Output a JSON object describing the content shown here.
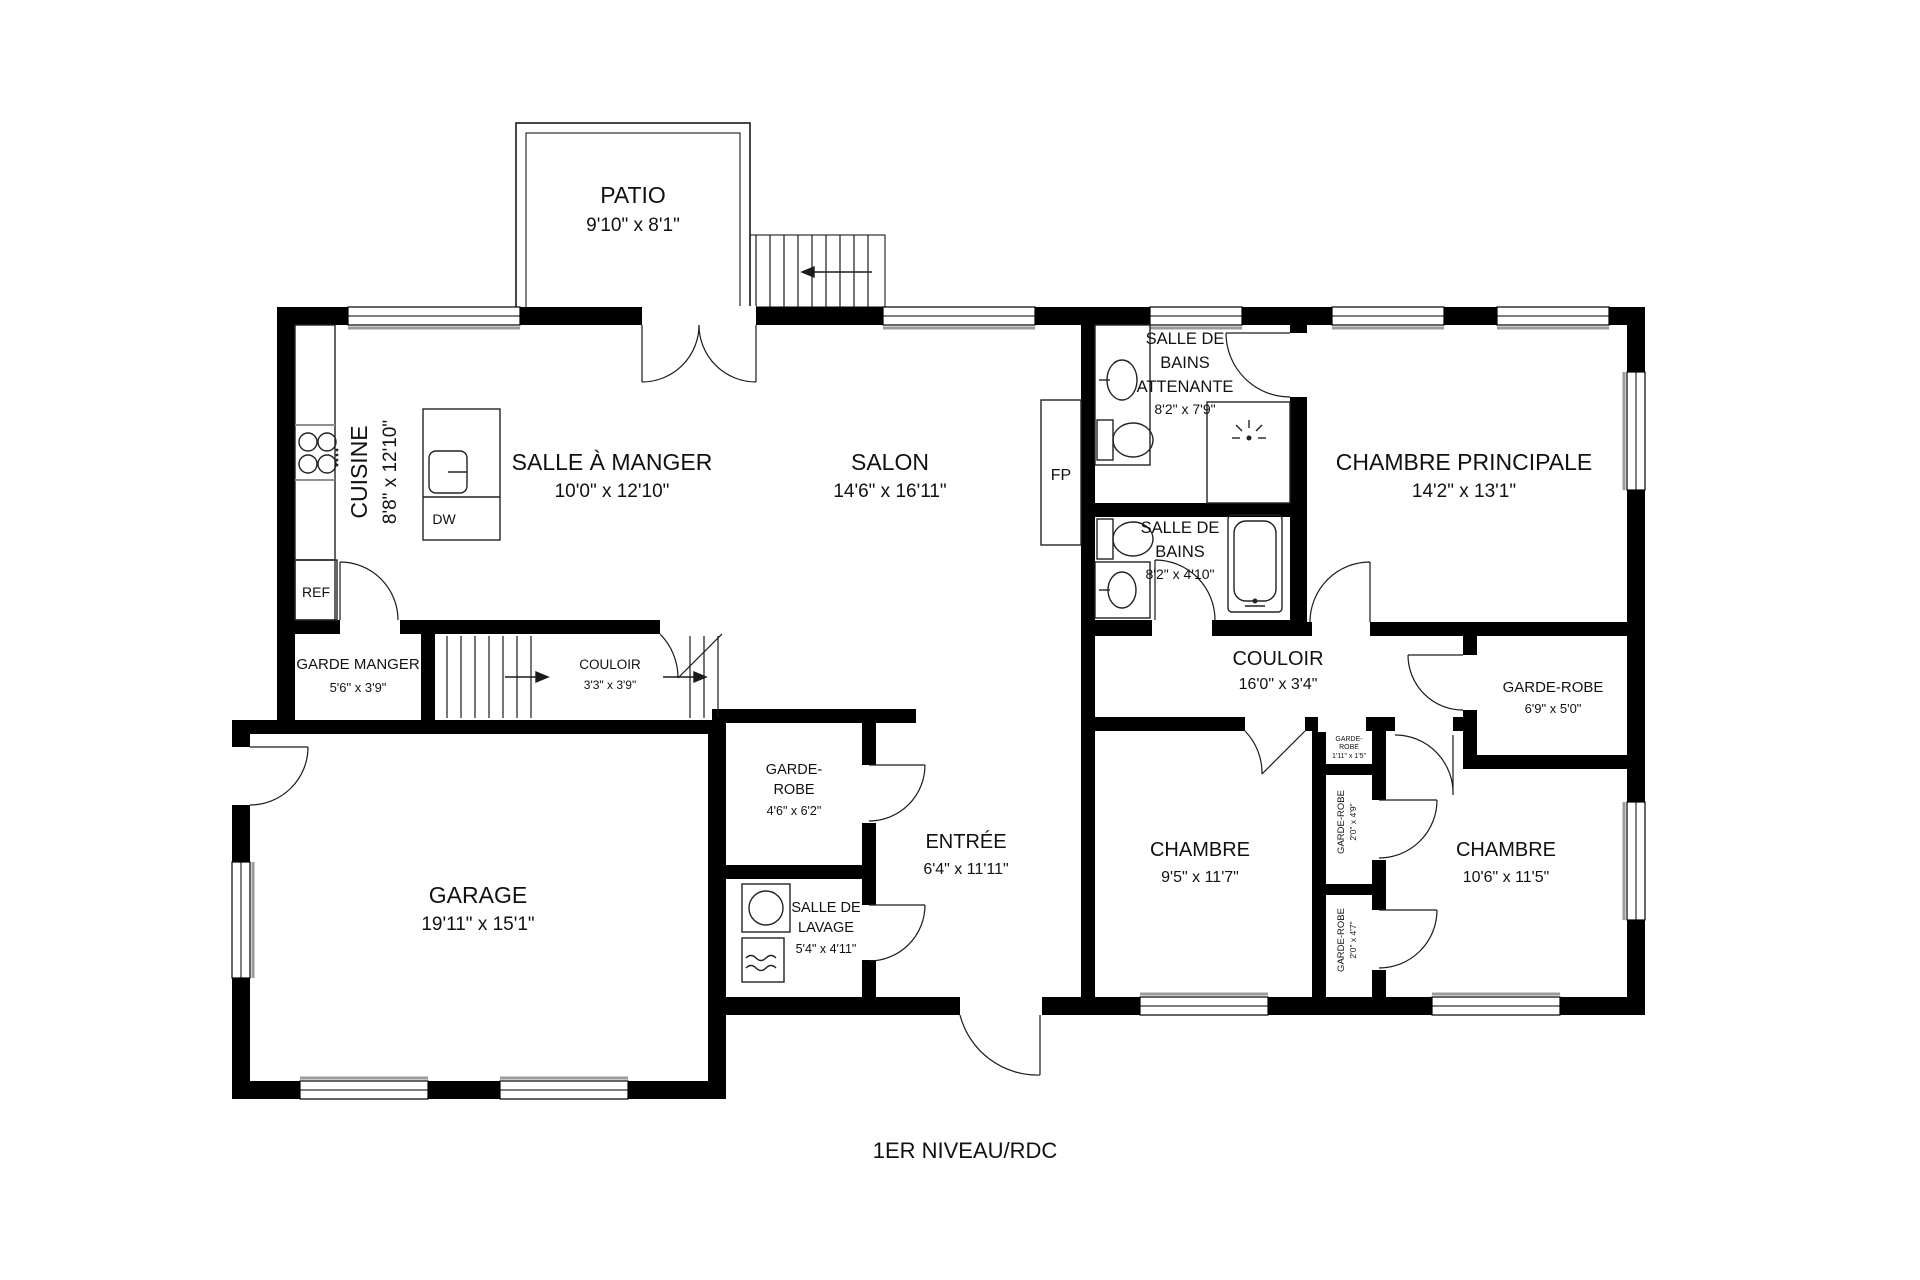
{
  "title": "1ER NIVEAU/RDC",
  "rooms": {
    "patio": {
      "name": "PATIO",
      "dims": "9'10\" x 8'1\""
    },
    "cuisine": {
      "name": "CUISINE",
      "dims": "8'8\" x 12'10\""
    },
    "salle_a_manger": {
      "name": "SALLE À MANGER",
      "dims": "10'0\" x 12'10\""
    },
    "salon": {
      "name": "SALON",
      "dims": "14'6\" x 16'11\""
    },
    "sdb_attenante": {
      "l1": "SALLE DE",
      "l2": "BAINS",
      "l3": "ATTENANTE",
      "dims": "8'2\" x 7'9\""
    },
    "chambre_principale": {
      "name": "CHAMBRE PRINCIPALE",
      "dims": "14'2\" x 13'1\""
    },
    "sdb": {
      "l1": "SALLE DE",
      "l2": "BAINS",
      "dims": "8'2\" x 4'10\""
    },
    "couloir": {
      "name": "COULOIR",
      "dims": "16'0\" x 3'4\""
    },
    "garde_robe_droite": {
      "name": "GARDE-ROBE",
      "dims": "6'9\" x 5'0\""
    },
    "garde_manger": {
      "name": "GARDE MANGER",
      "dims": "5'6\" x 3'9\""
    },
    "couloir_escalier": {
      "name": "COULOIR",
      "dims": "3'3\" x 3'9\""
    },
    "garde_robe_entree": {
      "l1": "GARDE-",
      "l2": "ROBE",
      "dims": "4'6\" x 6'2\""
    },
    "entree": {
      "name": "ENTRÉE",
      "dims": "6'4\" x 11'11\""
    },
    "garage": {
      "name": "GARAGE",
      "dims": "19'11\" x 15'1\""
    },
    "salle_lavage": {
      "l1": "SALLE DE",
      "l2": "LAVAGE",
      "dims": "5'4\" x 4'11\""
    },
    "chambre_centre": {
      "name": "CHAMBRE",
      "dims": "9'5\" x 11'7\""
    },
    "chambre_droite": {
      "name": "CHAMBRE",
      "dims": "10'6\" x 11'5\""
    },
    "garde_robe_petit": {
      "l1": "GARDE-",
      "l2": "ROBE",
      "dims": "1'11\" x 1'5\""
    },
    "garde_robe_haut": {
      "name": "GARDE-ROBE",
      "dims": "2'0\" x 4'9\""
    },
    "garde_robe_bas": {
      "name": "GARDE-ROBE",
      "dims": "2'0\" x 4'7\""
    }
  },
  "labels": {
    "ref": "REF",
    "dw": "DW",
    "fp": "FP"
  },
  "colors": {
    "wall": "#000000",
    "background": "#ffffff",
    "sill": "#9b9b9b"
  }
}
